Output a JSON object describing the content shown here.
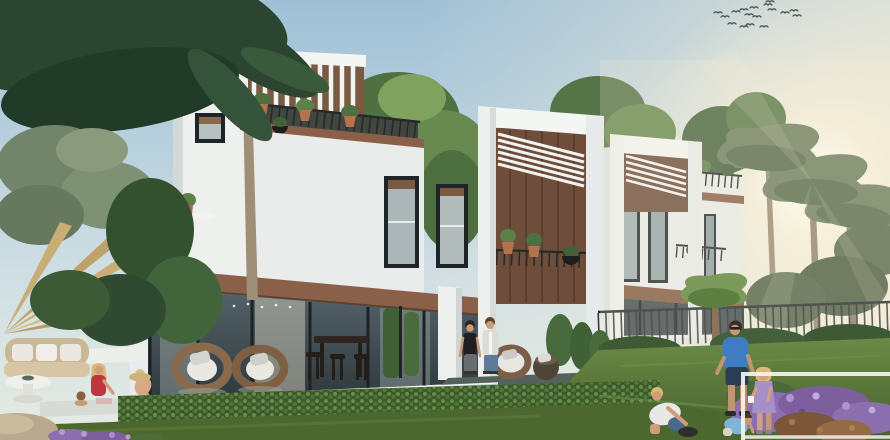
{
  "meta": {
    "kind": "architectural-exterior-rendering",
    "width_px": 890,
    "height_px": 440,
    "description": "Golden-hour rendering of a row of modern white townhouse villas with dark-wood accent bands, rooftop louvered pergola frames, plant-filled balconies, floor-to-ceiling ground glazing, a pool terrace with outdoor furniture on the left, a lawn with a family on the right, tropical palms on both sides, a flock of birds in the sky and a partial white frame overlay in the bottom-right corner."
  },
  "scene": {
    "sky": {
      "birds_count": 17,
      "sun": "low warm glow behind right-hand palms"
    },
    "buildings": [
      {
        "label": "left-townhouse",
        "floors": 3,
        "features": [
          "rooftop slatted pergola",
          "long balcony with dark railing and terracotta planters",
          "dark framed windows",
          "wood spandrel band",
          "glass ground floor with interior string lights"
        ]
      },
      {
        "label": "middle-townhouse",
        "features": [
          "projecting white frame box with diagonal louvre roof",
          "dark wood back wall",
          "balcony with planters and hanging black bowl",
          "glass ground floor"
        ]
      },
      {
        "label": "right-townhouse",
        "features": [
          "white frame box with louvre roof",
          "roof terrace railing with planters",
          "tall dark windows",
          "wood bands",
          "metal fence at garden"
        ]
      }
    ],
    "people": [
      {
        "label": "woman-in-pool",
        "clothing": "red swimsuit, blonde hair"
      },
      {
        "label": "child-straw-hat",
        "clothing": "straw sun hat, leaning at pool edge"
      },
      {
        "label": "child-in-pool",
        "clothing": "dark hair, in water"
      },
      {
        "label": "standing-woman",
        "clothing": "black top, grey trousers"
      },
      {
        "label": "standing-man",
        "clothing": "light shirt, blue jeans"
      },
      {
        "label": "father",
        "clothing": "blue t-shirt, navy shorts, sunglasses"
      },
      {
        "label": "boy-crouching",
        "clothing": "white t-shirt, blue shorts"
      },
      {
        "label": "toddler",
        "clothing": "light-blue top, bending to grass"
      },
      {
        "label": "girl",
        "clothing": "lavender dress, holding white cup"
      }
    ],
    "furniture": [
      "wicker sofa with white cushions",
      "white round coffee table",
      "white sun lounger",
      "two round rattan egg chairs with white cushions",
      "dark bar table with stools",
      "rattan armchair and dark pouf by the couple"
    ],
    "landscape": [
      "overhanging dark palm fronds top-left",
      "grey-green fan palm bush",
      "dry golden palm fan",
      "leafy trees behind rooflines",
      "backlit date palms on the right",
      "leaf hedge band",
      "lawn",
      "purple flower beds",
      "boulder bottom-left",
      "reflecting pool and main pool"
    ],
    "overlay": {
      "frame": "partial white rectangle outline entering from bottom-right edge"
    }
  },
  "palette": {
    "sky_top": "#9fc0d6",
    "sky_horizon": "#e6ebe3",
    "sun_glow": "#fff7e2",
    "warm_haze": "#f2ecd9",
    "building_white": "#eef0ee",
    "building_shadow": "#d3d8d9",
    "wood_accent": "#8a6148",
    "wood_dark": "#6e4e3b",
    "window_glass": "#2f3b40",
    "glass_reflection": "#b7c1bf",
    "railing_metal": "#26292a",
    "foliage_dark": "#2c4530",
    "foliage_mid": "#4e7040",
    "foliage_light": "#7fa35f",
    "palm_gray": "#72856a",
    "dry_frond": "#c9ad74",
    "trunk": "#a08f77",
    "lawn_light": "#6b8a46",
    "lawn_dark": "#47612e",
    "hedge_green": "#3c5a2e",
    "pool_water": "#b4c9cf",
    "deck": "#d7dbd6",
    "terracotta": "#b3734f",
    "rattan": "#8a6a4c",
    "cushion_white": "#eae8e0",
    "skin": "#c89a78",
    "overlay_white": "#f6f4ef",
    "purple_flowers": "#8b6fae",
    "rock": "#b9a98e",
    "blue_shirt": "#3e7dc2",
    "red_swimsuit": "#c03540",
    "lavender_dress": "#a78fc8",
    "light_blue_top": "#7fb3d8",
    "denim": "#5d7a9a"
  }
}
